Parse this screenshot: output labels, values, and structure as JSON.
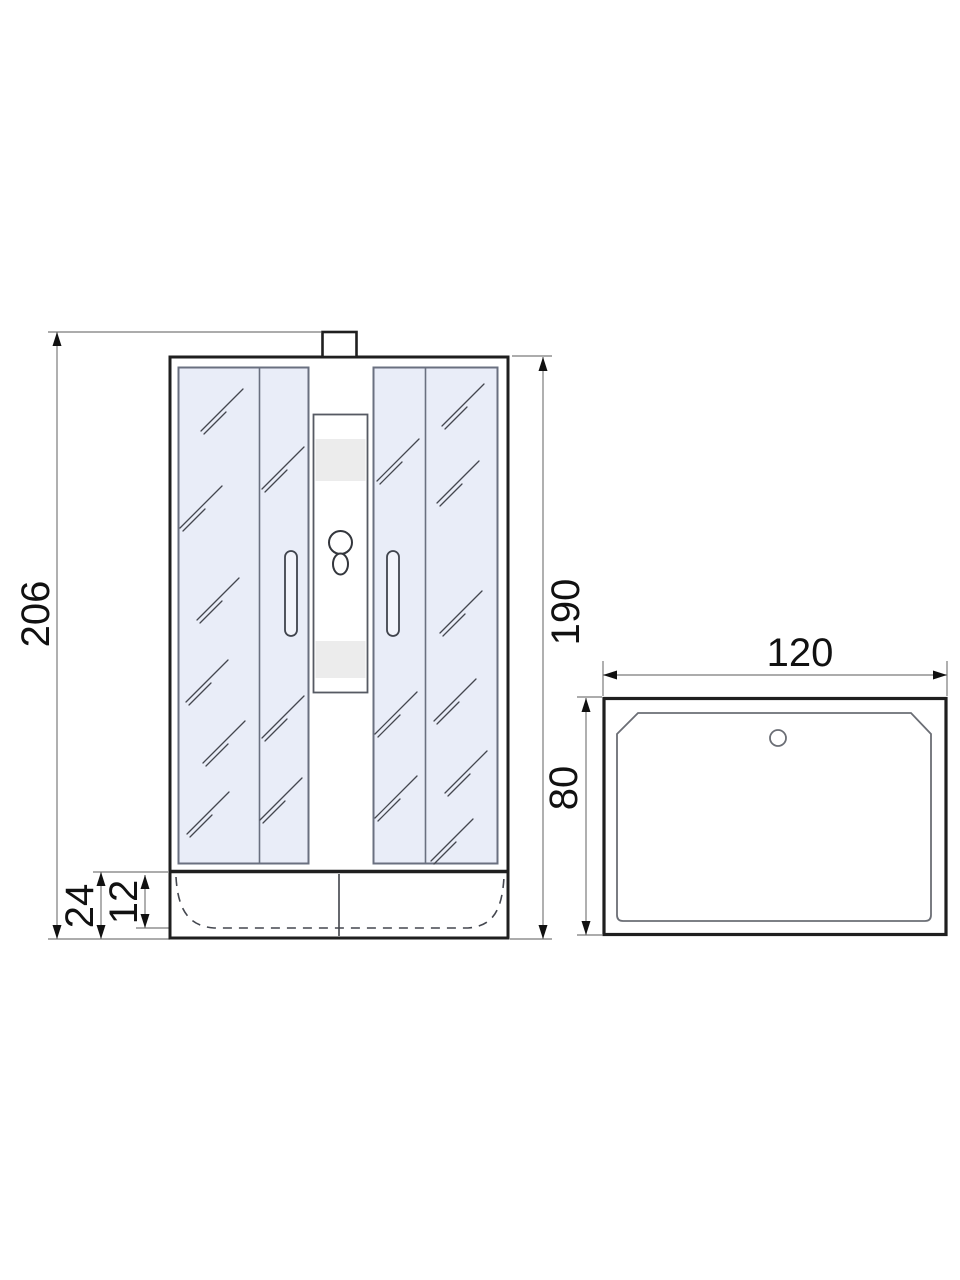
{
  "diagram": {
    "title": "shower-cabin-technical-drawing",
    "views": {
      "front": {
        "label": "front-view",
        "dims": {
          "total_height": "206",
          "glass_height": "190",
          "tray_height": "24",
          "tray_inner_depth": "12"
        }
      },
      "top": {
        "label": "top-view",
        "dims": {
          "width": "120",
          "depth": "80"
        }
      }
    },
    "colors": {
      "outline": "#1f1f1f",
      "dimension_line": "#7b7b7b",
      "dimension_text": "#111111",
      "glass_fill": "#e9edf8",
      "glass_border": "#6a7080",
      "panel_band": "#ececec",
      "detail_line": "#44474f",
      "white": "#ffffff"
    }
  }
}
